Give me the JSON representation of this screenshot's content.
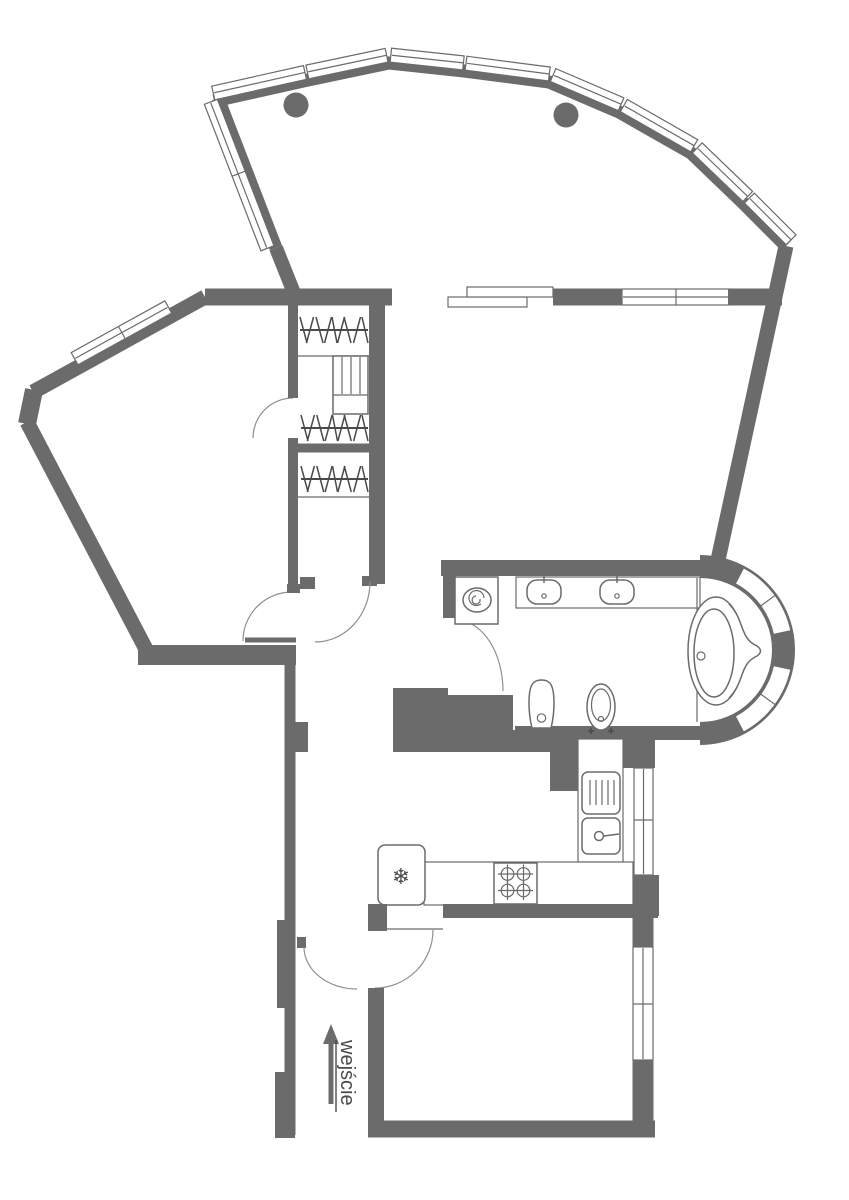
{
  "document": {
    "type": "apartment-floor-plan",
    "entrance_label": "wejście"
  },
  "icons": {
    "snowflake": "❄"
  },
  "colors": {
    "wall": "#6b6b6b",
    "line": "#6b6b6b",
    "dark": "#4a4a4a",
    "bg": "#ffffff"
  },
  "fixtures": [
    "balcony-window-band",
    "half-column",
    "sliding-balcony-door",
    "wardrobe-hanger-rod",
    "shelf-unit",
    "washing-machine",
    "double-sink-counter",
    "toilet",
    "bidet",
    "corner-bathtub",
    "bay-glass-wall",
    "fridge",
    "stove-4-burners",
    "kitchen-counter",
    "kitchen-sink",
    "dish-drainer",
    "entrance-arrow",
    "window",
    "door-arc"
  ]
}
